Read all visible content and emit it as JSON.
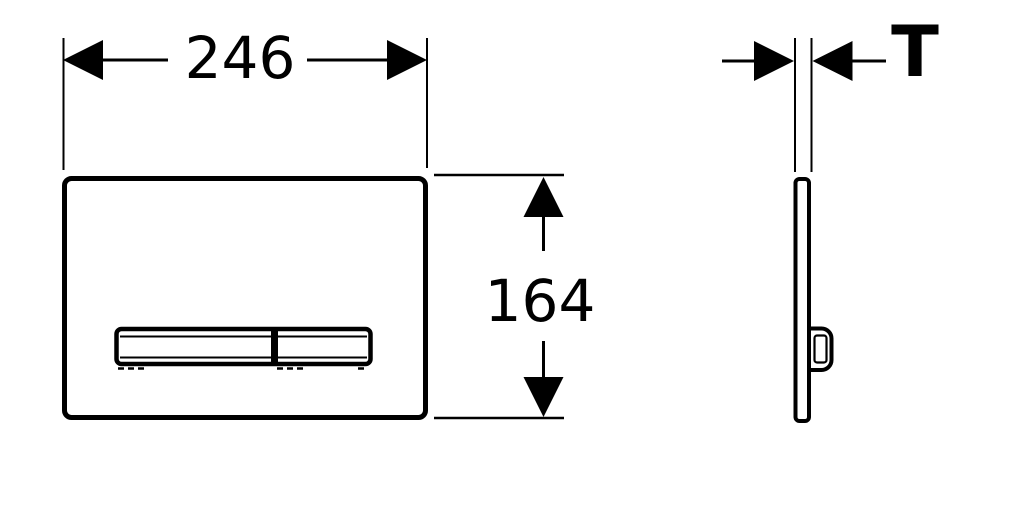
{
  "colors": {
    "background": "#ffffff",
    "line": "#000000"
  },
  "front_view": {
    "width_dimension": {
      "label": "246"
    },
    "height_dimension": {
      "label": "164"
    }
  },
  "side_view": {
    "thickness_dimension": {
      "label": "T"
    }
  }
}
